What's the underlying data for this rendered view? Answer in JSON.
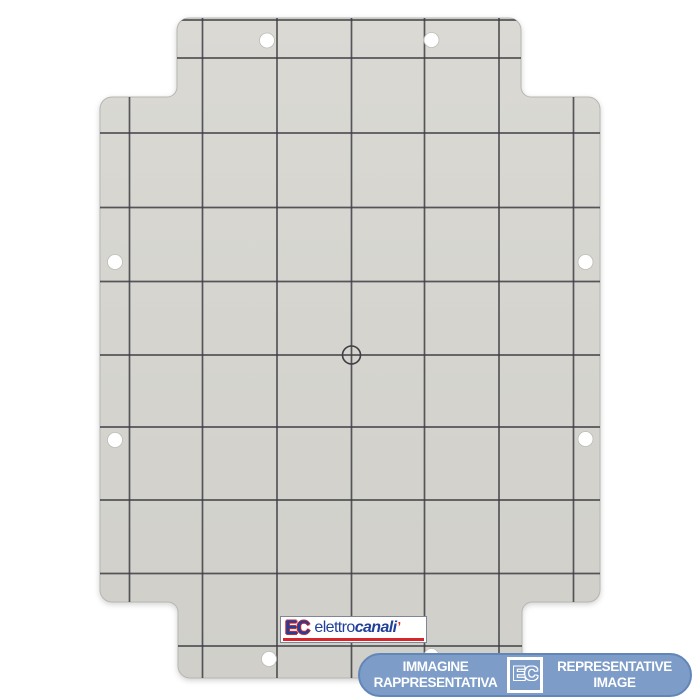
{
  "stage": {
    "background": "#ffffff"
  },
  "plate": {
    "fill_top": "#dad9d4",
    "fill_bottom": "#d0cfc9",
    "edge_color": "#b7b6b0",
    "grid_color": "#3e3e44",
    "hole_fill": "#ffffff",
    "geometry": {
      "outline": "M 189 18 L 509 18 A 12 12 0 0 1 521 30 L 521 87 A 10 10 0 0 0 531 97 L 588 97 A 12 12 0 0 1 600 109 L 600 590 A 12 12 0 0 1 588 602 L 532 602 A 10 10 0 0 0 522 612 L 522 666 A 12 12 0 0 1 510 678 L 190 678 A 12 12 0 0 1 178 666 L 178 612 A 10 10 0 0 0 168 602 L 112 602 A 12 12 0 0 1 100 590 L 100 109 A 12 12 0 0 1 112 97 L 167 97 A 10 10 0 0 0 177 87 L 177 30 A 12 12 0 0 1 189 18 Z",
      "grid_x": [
        129.5,
        202.5,
        277,
        351.5,
        424.5,
        499,
        573.5
      ],
      "grid_y": [
        20,
        58,
        133,
        207.5,
        281.5,
        355,
        427,
        500,
        573.5,
        646
      ],
      "holes": [
        [
          267,
          40.5
        ],
        [
          431.5,
          40
        ],
        [
          115,
          262
        ],
        [
          585.5,
          262
        ],
        [
          115,
          440
        ],
        [
          585.5,
          439
        ],
        [
          269,
          659
        ],
        [
          431.5,
          656
        ]
      ],
      "hole_radius": 7.5,
      "center_mark": {
        "x": 351.5,
        "y": 355,
        "r": 9
      }
    }
  },
  "logo": {
    "monogram": "EC",
    "brand_regular": "elettro",
    "brand_bold": "canali",
    "accent": "’",
    "text_color": "#21409a",
    "accent_color": "#d5262b"
  },
  "watermark_banner": {
    "line1_it": "IMMAGINE",
    "line2_it": "RAPPRESENTATIVA",
    "monogram": "EC",
    "line1_en": "REPRESENTATIVE",
    "line2_en": "IMAGE",
    "background": "#7d9cc8",
    "border_color": "#6186b8",
    "text_color": "#ffffff"
  }
}
